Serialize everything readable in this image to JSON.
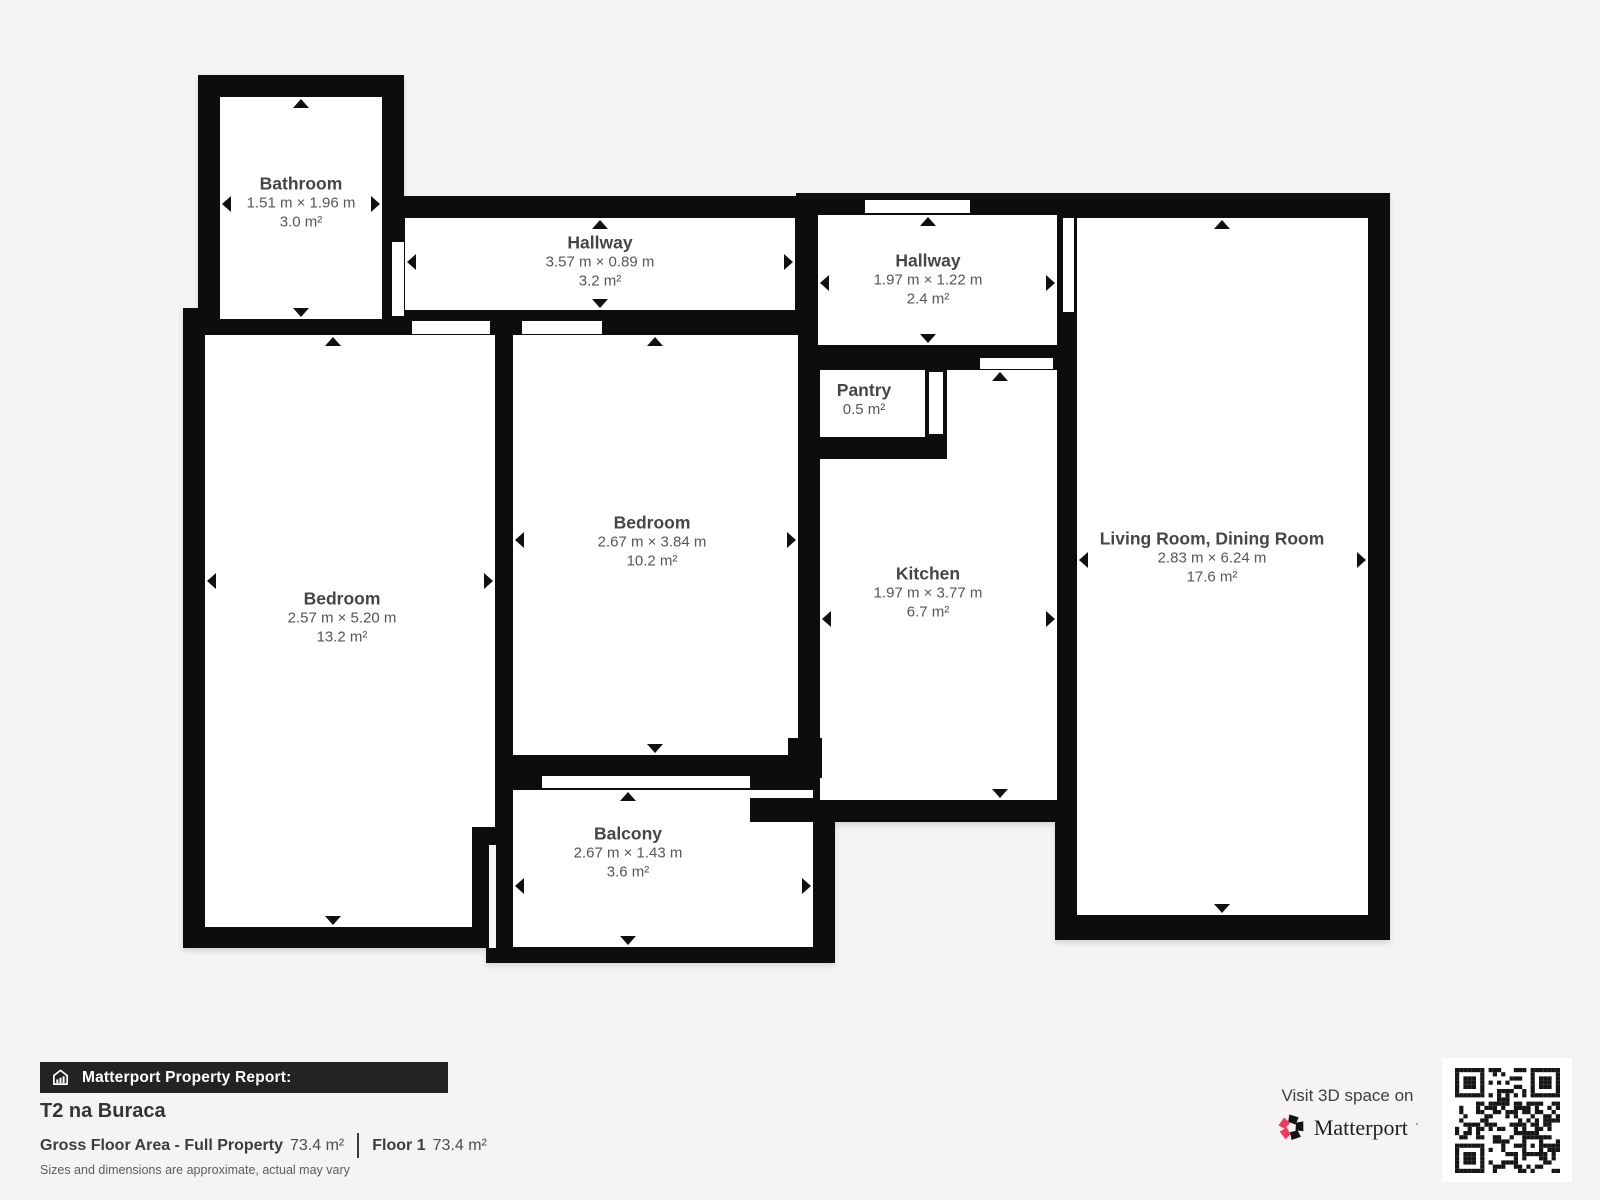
{
  "plan": {
    "rooms": [
      {
        "name": "Bathroom",
        "dims": "1.51 m × 1.96 m",
        "area": "3.0 m²"
      },
      {
        "name": "Hallway",
        "dims": "3.57 m × 0.89 m",
        "area": "3.2 m²"
      },
      {
        "name": "Hallway",
        "dims": "1.97 m × 1.22 m",
        "area": "2.4 m²"
      },
      {
        "name": "Pantry",
        "dims": "",
        "area": "0.5 m²"
      },
      {
        "name": "Bedroom",
        "dims": "2.67 m × 3.84 m",
        "area": "10.2 m²"
      },
      {
        "name": "Bedroom",
        "dims": "2.57 m × 5.20 m",
        "area": "13.2 m²"
      },
      {
        "name": "Kitchen",
        "dims": "1.97 m × 3.77 m",
        "area": "6.7 m²"
      },
      {
        "name": "Living Room, Dining Room",
        "dims": "2.83 m × 6.24 m",
        "area": "17.6 m²"
      },
      {
        "name": "Balcony",
        "dims": "2.67 m × 1.43 m",
        "area": "3.6 m²"
      }
    ]
  },
  "report": {
    "bar_label": "Matterport Property Report:",
    "property_name": "T2 na Buraca",
    "gross_label": "Gross Floor Area - Full Property",
    "gross_value": "73.4 m²",
    "floor_label": "Floor 1",
    "floor_value": "73.4 m²",
    "disclaimer": "Sizes and dimensions are approximate, actual may vary"
  },
  "cta": {
    "visit_text": "Visit 3D space on",
    "brand": "Matterport"
  },
  "colors": {
    "wall": "#0d0d0d",
    "background": "#f5f4f2",
    "brand_pink": "#f43a5c",
    "report_bar": "#232323"
  }
}
